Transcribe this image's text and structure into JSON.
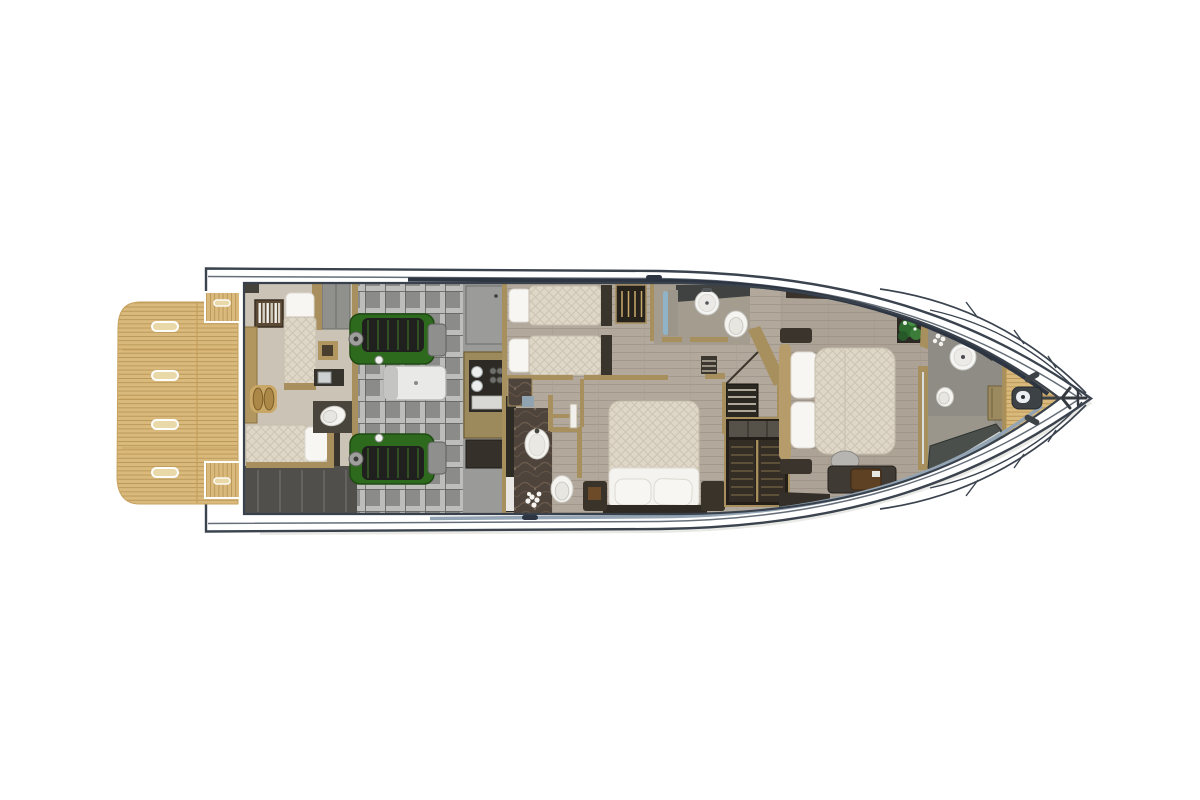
{
  "page": {
    "title": "Motor yacht lower deck floor plan — top-down rendering"
  },
  "colors": {
    "hull-line": "#3a434e",
    "accent-line": "#4a5560",
    "navy-band": "#2c3541",
    "waterline-band": "#93a4b4",
    "teak": "#d9b97c",
    "teak-line": "#b3914f",
    "wood": "#b2a89b",
    "wood-line": "#a1978a",
    "crew-floor": "#cbc4b6",
    "engine-floor": "#8b8b89",
    "grid-light": "#bdbdbb",
    "engine-green": "#2e6a1e",
    "tan": "#a78f5e",
    "dark-furn": "#39332b",
    "marble": "#4e443b",
    "fixture": "#f5f4f0",
    "quilt": "#ded7c7",
    "glass-blue": "#8fb4ca",
    "plant": "#2e6b2e",
    "bilge": "#504f4b",
    "stairs": "#2b2721",
    "wardrobe": "#241f19",
    "shower-glass": "#4b4f4b"
  },
  "vessel": {
    "view": "lower-deck top view",
    "orientation": "bow to the right, stern to the left",
    "regions": [
      {
        "name": "swim-platform",
        "features": [
          "teak planking",
          "4 deck hatches",
          "2 transom step pads"
        ]
      },
      {
        "name": "crew-cabin",
        "features": [
          "single berth fore-aft",
          "single berth athwartships",
          "bookshelf",
          "dinette with 2 stools",
          "wet head with toilet and sink",
          "lockers"
        ]
      },
      {
        "name": "engine-room",
        "features": [
          "port engine",
          "starboard engine",
          "generator",
          "structural grid floor",
          "access hatches"
        ]
      },
      {
        "name": "crew-galley",
        "features": [
          "sink",
          "2-burner stove",
          "storage cabinet"
        ]
      },
      {
        "name": "twin-guest-cabin",
        "features": [
          "two single beds",
          "open wardrobe with hangers"
        ]
      },
      {
        "name": "guest-bathroom",
        "features": [
          "round basin on counter",
          "toilet",
          "shower with blue glass door"
        ]
      },
      {
        "name": "vip-cabin",
        "features": [
          "double bed with two pillows",
          "side benches"
        ]
      },
      {
        "name": "vip-bathroom",
        "features": [
          "oval basin",
          "toilet",
          "marble floor",
          "flowers",
          "white door"
        ]
      },
      {
        "name": "companionway",
        "features": [
          "staircase to main deck",
          "landing"
        ]
      },
      {
        "name": "walk-in-wardrobe",
        "features": [
          "louvered cabinet",
          "top shelves"
        ]
      },
      {
        "name": "master-cabin",
        "features": [
          "queen bed with two pillows",
          "nightstands",
          "desk with chair and briefcase",
          "sofa",
          "potted plant",
          "glass partition"
        ]
      },
      {
        "name": "master-bathroom",
        "features": [
          "angled vanity with round basin",
          "flower vase",
          "toilet",
          "glass shower",
          "teak-edge cabinet"
        ]
      },
      {
        "name": "bow-deck",
        "features": [
          "teak foredeck",
          "anchor windlass",
          "anchor",
          "two cleats",
          "bow rails with stanchions"
        ]
      }
    ]
  }
}
